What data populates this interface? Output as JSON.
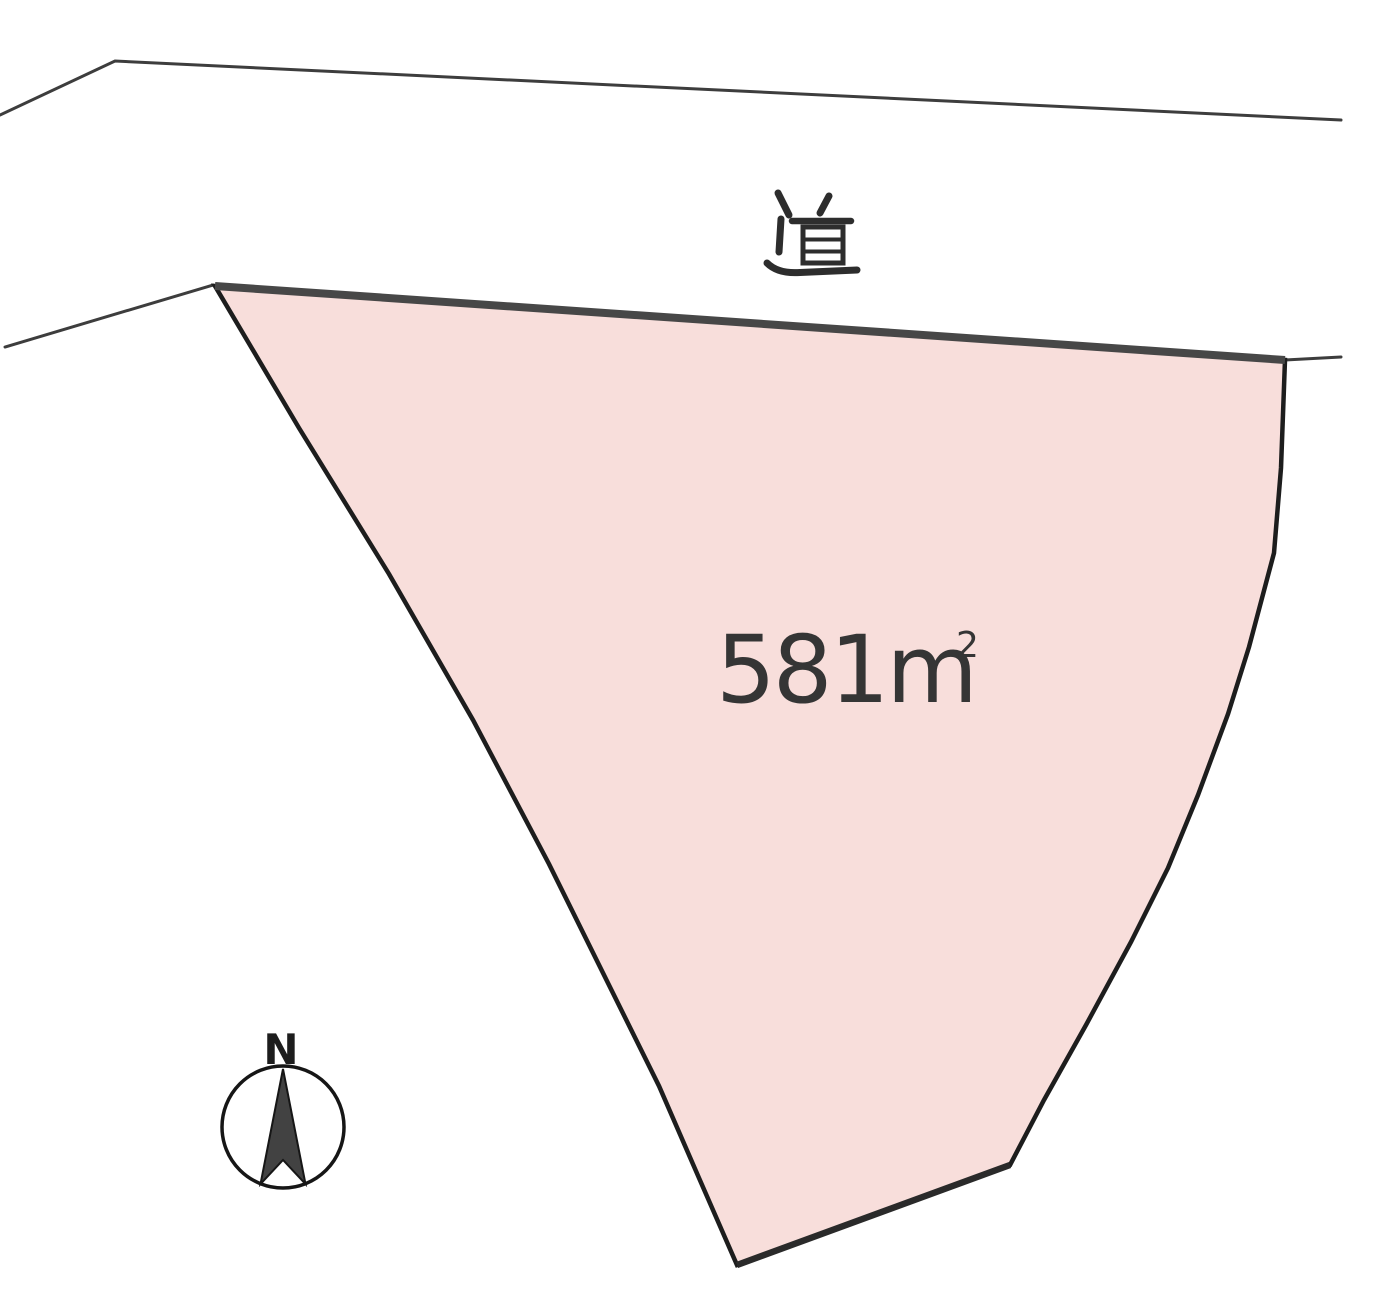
{
  "road": {
    "label": "道"
  },
  "plot": {
    "area_value": "581m",
    "area_exponent": "2",
    "fill_color": "#f8dedb"
  },
  "compass": {
    "label": "N"
  }
}
